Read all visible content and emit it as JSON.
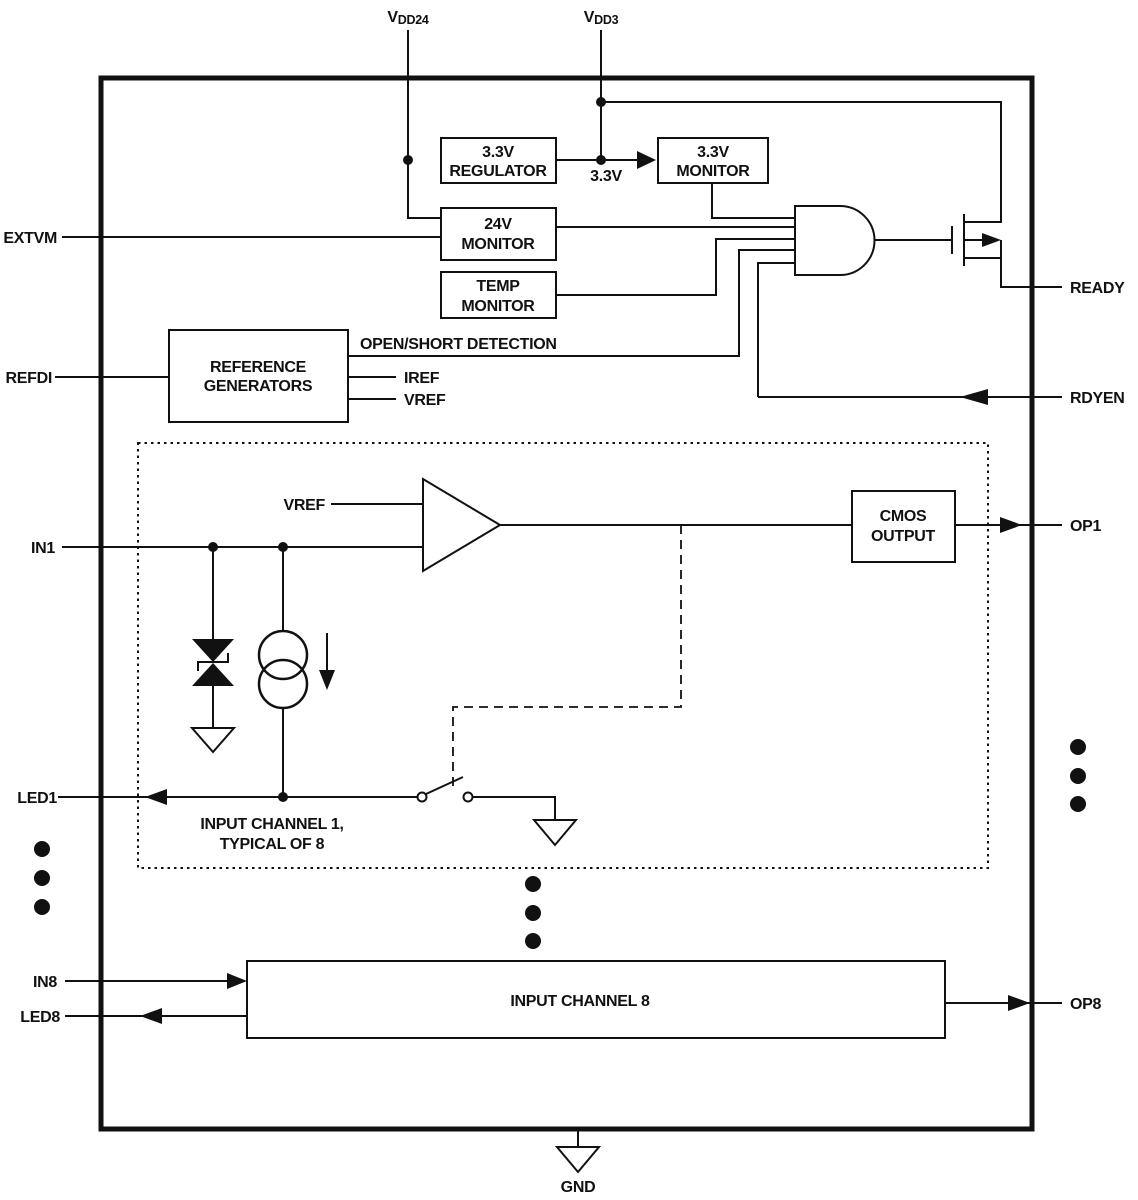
{
  "diagram": {
    "background": "#ffffff",
    "line_color": "#111111",
    "pins": {
      "vdd24": {
        "main": "V",
        "sub": "DD24"
      },
      "vdd3": {
        "main": "V",
        "sub": "DD3"
      },
      "extvm": "EXTVM",
      "refdi": "REFDI",
      "in1": "IN1",
      "led1": "LED1",
      "in8": "IN8",
      "led8": "LED8",
      "ready": "READY",
      "rdyen": "RDYEN",
      "op1": "OP1",
      "op8": "OP8",
      "gnd": "GND"
    },
    "blocks": {
      "regulator_33v": {
        "line1": "3.3V",
        "line2": "REGULATOR"
      },
      "monitor_33v": {
        "line1": "3.3V",
        "line2": "MONITOR"
      },
      "monitor_24v": {
        "line1": "24V",
        "line2": "MONITOR"
      },
      "monitor_temp": {
        "line1": "TEMP",
        "line2": "MONITOR"
      },
      "reference_generators": {
        "line1": "REFERENCE",
        "line2": "GENERATORS"
      },
      "cmos_output": {
        "line1": "CMOS",
        "line2": "OUTPUT"
      },
      "input_channel_8": {
        "label": "INPUT CHANNEL 8"
      }
    },
    "nets": {
      "rail_33v": "3.3V",
      "open_short": "OPEN/SHORT DETECTION",
      "iref": "IREF",
      "vref": "VREF",
      "vref_channel": "VREF"
    },
    "notes": {
      "channel_line1": "INPUT CHANNEL 1,",
      "channel_line2": "TYPICAL OF 8"
    }
  }
}
